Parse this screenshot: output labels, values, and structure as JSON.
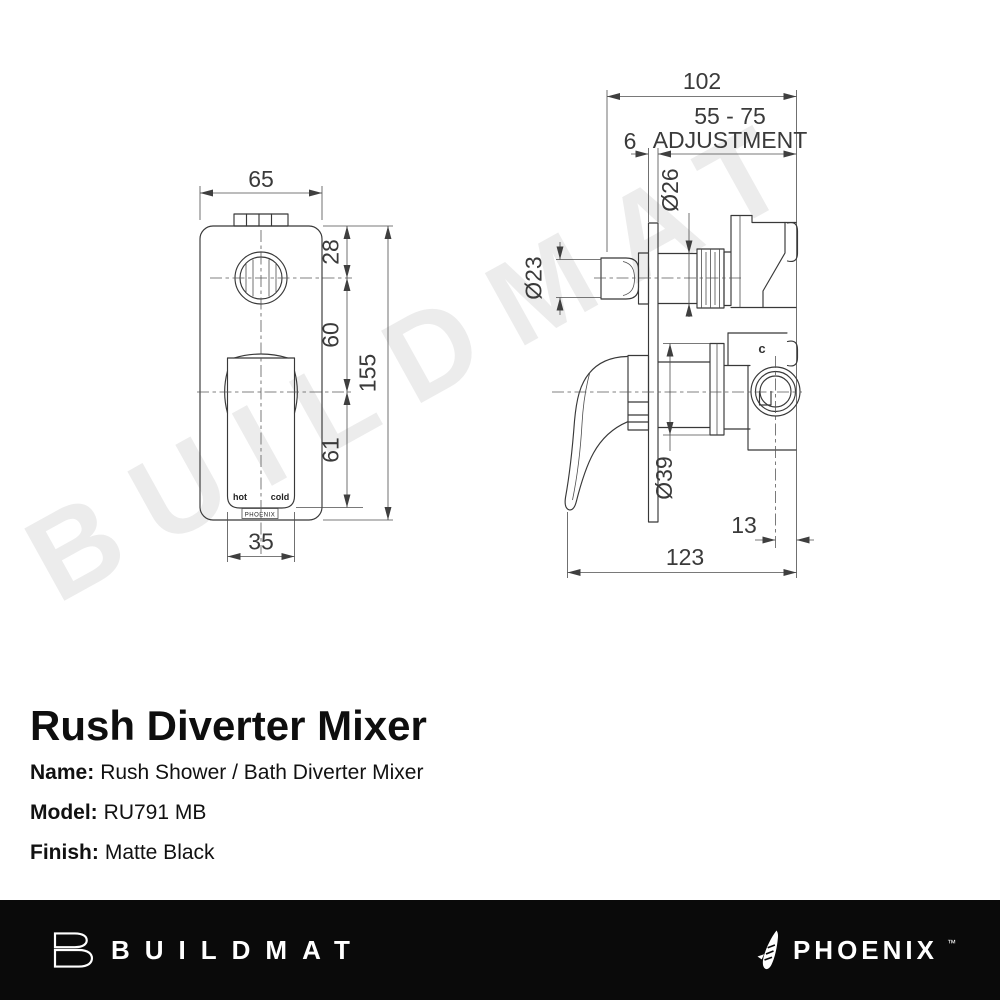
{
  "watermark": {
    "text": "BUILDMAT"
  },
  "product": {
    "title": "Rush Diverter Mixer",
    "specs": [
      {
        "label": "Name:",
        "value": "Rush Shower / Bath Diverter Mixer"
      },
      {
        "label": "Model:",
        "value": "RU791 MB"
      },
      {
        "label": "Finish:",
        "value": "Matte Black"
      }
    ]
  },
  "front_view": {
    "dims": {
      "width": "65",
      "top_to_button": "28",
      "button_to_handle": "60",
      "handle_to_bottom": "61",
      "height": "155",
      "handle_width": "35"
    },
    "labels": {
      "hot": "hot",
      "cold": "cold",
      "plate_brand": "PHOENIX"
    }
  },
  "side_view": {
    "dims": {
      "depth": "102",
      "adjustment_range": "55 - 75",
      "adjustment_word": "ADJUSTMENT",
      "plate_thickness": "6",
      "shaft_diameter": "Ø26",
      "button_diameter": "Ø23",
      "flange_diameter": "Ø39",
      "outlet_offset": "13",
      "total_depth": "123"
    },
    "labels": {
      "cold_marker": "c"
    }
  },
  "footer": {
    "background": "#0a0a0a",
    "buildmat": "BUILDMAT",
    "phoenix": "PHOENIX",
    "trademark": "™"
  }
}
